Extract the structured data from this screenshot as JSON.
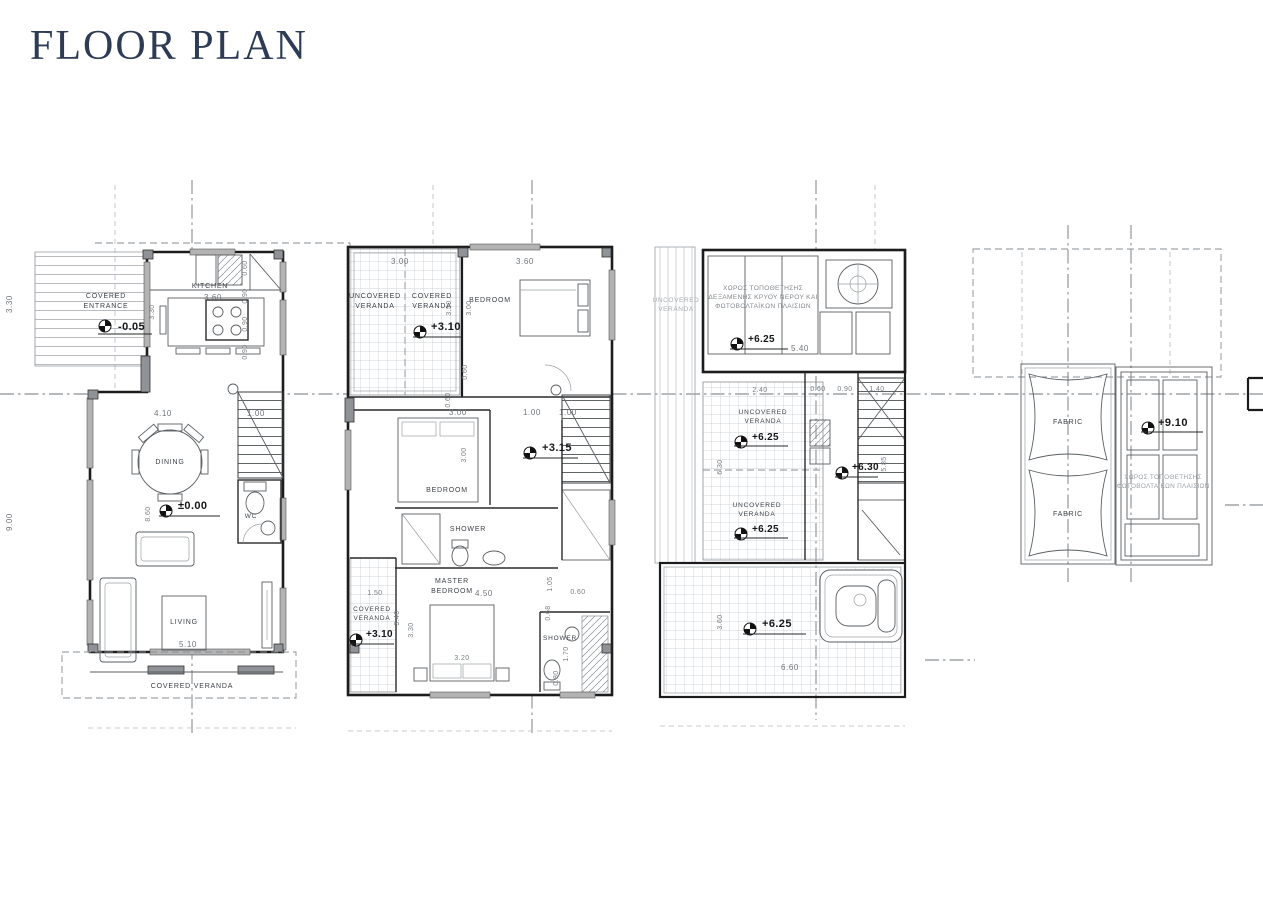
{
  "title": "FLOOR PLAN",
  "colors": {
    "title": "#2e3b54",
    "ink": "#1c1c1c",
    "window_fill": "#b3b3b3",
    "tile_line": "#c0c7cd"
  },
  "p1": {
    "rooms": {
      "entrance": [
        "COVERED",
        "ENTRANCE"
      ],
      "kitchen": "KITCHEN",
      "dining": "DINING",
      "living": "LIVING",
      "wc": "WC",
      "veranda": "COVERED VERANDA"
    },
    "levels": {
      "entrance": "-0.05",
      "main": "±0.00"
    },
    "dims": {
      "d330": "3.30",
      "d900": "9.00",
      "d330b": "3.30",
      "d360": "3.60",
      "d060": "0.60",
      "d090a": "0.90",
      "d090b": "0.90",
      "d090c": "0.90",
      "d410": "4.10",
      "d100": "1.00",
      "d860": "8.60",
      "d510": "5.10"
    }
  },
  "p2": {
    "rooms": {
      "uncovered": [
        "UNCOVERED",
        "VERANDA"
      ],
      "covered_top": [
        "COVERED",
        "VERANDA"
      ],
      "bedroom_top": "BEDROOM",
      "bedroom_mid": "BEDROOM",
      "shower_mid": "SHOWER",
      "master": [
        "MASTER",
        "BEDROOM"
      ],
      "covered_bottom": [
        "COVERED",
        "VERANDA"
      ],
      "shower_bottom": "SHOWER"
    },
    "levels": {
      "veranda_top": "+3.10",
      "landing": "+3.15",
      "veranda_bottom": "+3.10"
    },
    "dims": {
      "d300top": "3.00",
      "d360": "3.60",
      "d350": "3.50",
      "d300v": "3.00",
      "d060a": "0.60",
      "d060b": "0.60",
      "d300mid": "3.00",
      "d100a": "1.00",
      "d100b": "1.00",
      "d300v2": "3.00",
      "d150": "1.50",
      "d340": "3.40",
      "d330": "3.30",
      "d450": "4.50",
      "d320": "3.20",
      "d105": "1.05",
      "d060c": "0.60",
      "d068": "0.68",
      "d170": "1.70",
      "d080": "0.80"
    }
  },
  "p3": {
    "labels": {
      "veranda_left": [
        "UNCOVERED",
        "VERANDA"
      ],
      "tank": [
        "ΧΩΡΟΣ ΤΟΠΟΘΕΤΗΣΗΣ",
        "ΔΕΞΑΜΕΝΗΣ ΚΡΥΟΥ ΝΕΡΟΥ ΚΑΙ",
        "ΦΩΤΟΒΟΛΤΑΪΚΩΝ ΠΛΑΙΣΙΩΝ"
      ],
      "veranda_mid1": [
        "UNCOVERED",
        "VERANDA"
      ],
      "veranda_mid2": [
        "UNCOVERED",
        "VERANDA"
      ]
    },
    "levels": {
      "top": "+6.25",
      "mid1": "+6.25",
      "mid2": "+6.25",
      "landing": "+6.30",
      "terrace": "+6.25"
    },
    "dims": {
      "d540": "5.40",
      "d240": "2.40",
      "d060": "0.60",
      "d090": "0.90",
      "d140": "1.40",
      "d630": "6.30",
      "d585": "5.85",
      "d360": "3.60",
      "d660": "6.60"
    }
  },
  "p4": {
    "labels": {
      "fabric_top": "FABRIC",
      "fabric_bottom": "FABRIC",
      "pv": [
        "ΧΩΡΟΣ ΤΟΠΟΘΕΤΗΣΗΣ",
        "ΦΩΤΟΒΟΛΤΑΪΚΩΝ ΠΛΑΙΣΙΩΝ"
      ]
    },
    "levels": {
      "roof": "+9.10"
    }
  }
}
